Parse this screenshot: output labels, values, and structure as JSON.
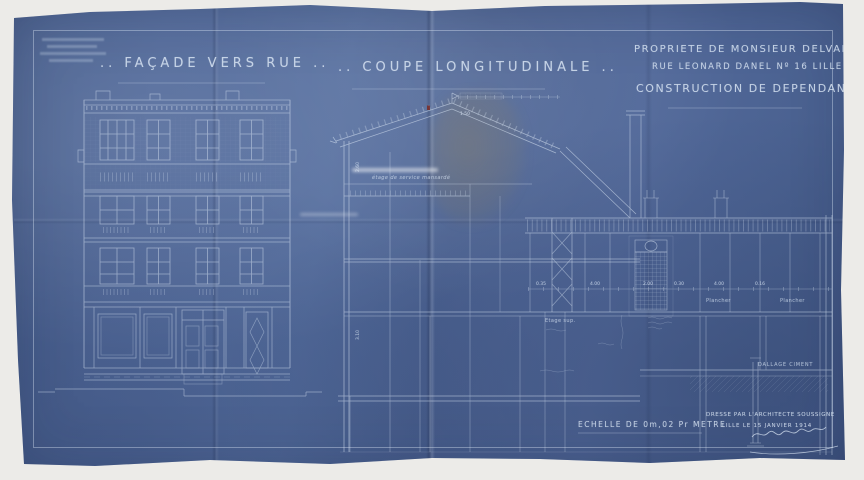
{
  "titles": {
    "facade": ".. FAÇADE VERS RUE ..",
    "coupe": ".. COUPE LONGITUDINALE .."
  },
  "title_block": {
    "line1": "PROPRIETE DE MONSIEUR DELVALLE",
    "line2": "RUE LEONARD DANEL Nº 16 LILLE",
    "line3": "CONSTRUCTION DE DEPENDANCES"
  },
  "footer": {
    "scale": "ECHELLE DE 0m,02 Pr METRE",
    "drawn_by": "DRESSE PAR L'ARCHITECTE SOUSSIGNE",
    "place_date": "LILLE LE 15 JANVIER 1914"
  },
  "annotations": {
    "attic": "étage de service mansardé",
    "etage_sup": "Etage sup.",
    "plancher": "Plancher",
    "dallage": "DALLAGE CIMENT"
  },
  "dimensions": {
    "v1": "2.60",
    "v2": "3.10",
    "c1": "0.35",
    "c2": "4.00",
    "c3": "2.00",
    "c4": "0.30",
    "c5": "4.00",
    "c6": "0.16",
    "roof": "1.50"
  },
  "colors": {
    "paper_blue": "#4f6896",
    "line": "#d7e3f2",
    "scan_background": "#ecebe8",
    "accent_red": "#7a2c28"
  }
}
